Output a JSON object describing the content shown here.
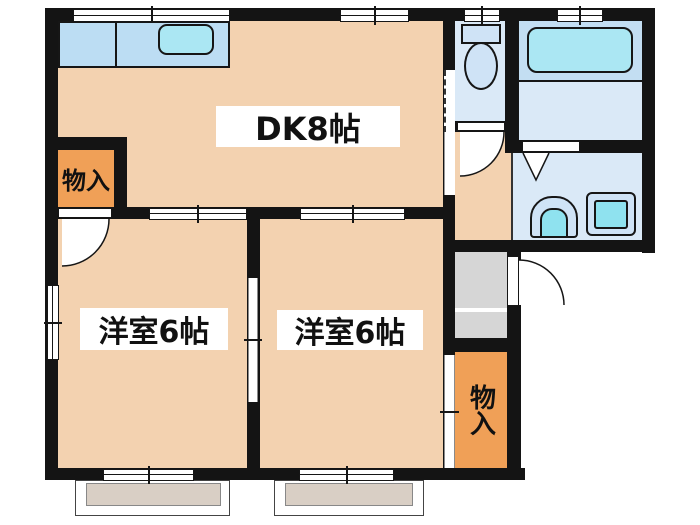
{
  "floorplan": {
    "type": "apartment-floor-plan",
    "labels": {
      "dk": "DK8帖",
      "room1": "洋室6帖",
      "room2": "洋室6帖",
      "closet_top": "物入",
      "closet_bottom": "物入"
    },
    "fixtures": [
      "kitchen-counter",
      "kitchen-sink",
      "toilet",
      "bathtub",
      "bath-folding-door",
      "washbasin",
      "washing-machine",
      "entrance",
      "entrance-door",
      "balcony",
      "balcony",
      "sliding-doors",
      "windows"
    ],
    "colors": {
      "wall": "#141414",
      "room": "#F3D2B0",
      "closet": "#F0A057",
      "wet": "#DAE9F7",
      "deck": "#C3DEF2",
      "counter": "#BCDDF3",
      "cyan": "#ABE7F3",
      "appliance": "#8FE2EF",
      "fixture": "#CFE3F6",
      "balcony": "#D9CFC5",
      "entry": "#D6D6D6",
      "plate": "#FFFFFF"
    }
  }
}
